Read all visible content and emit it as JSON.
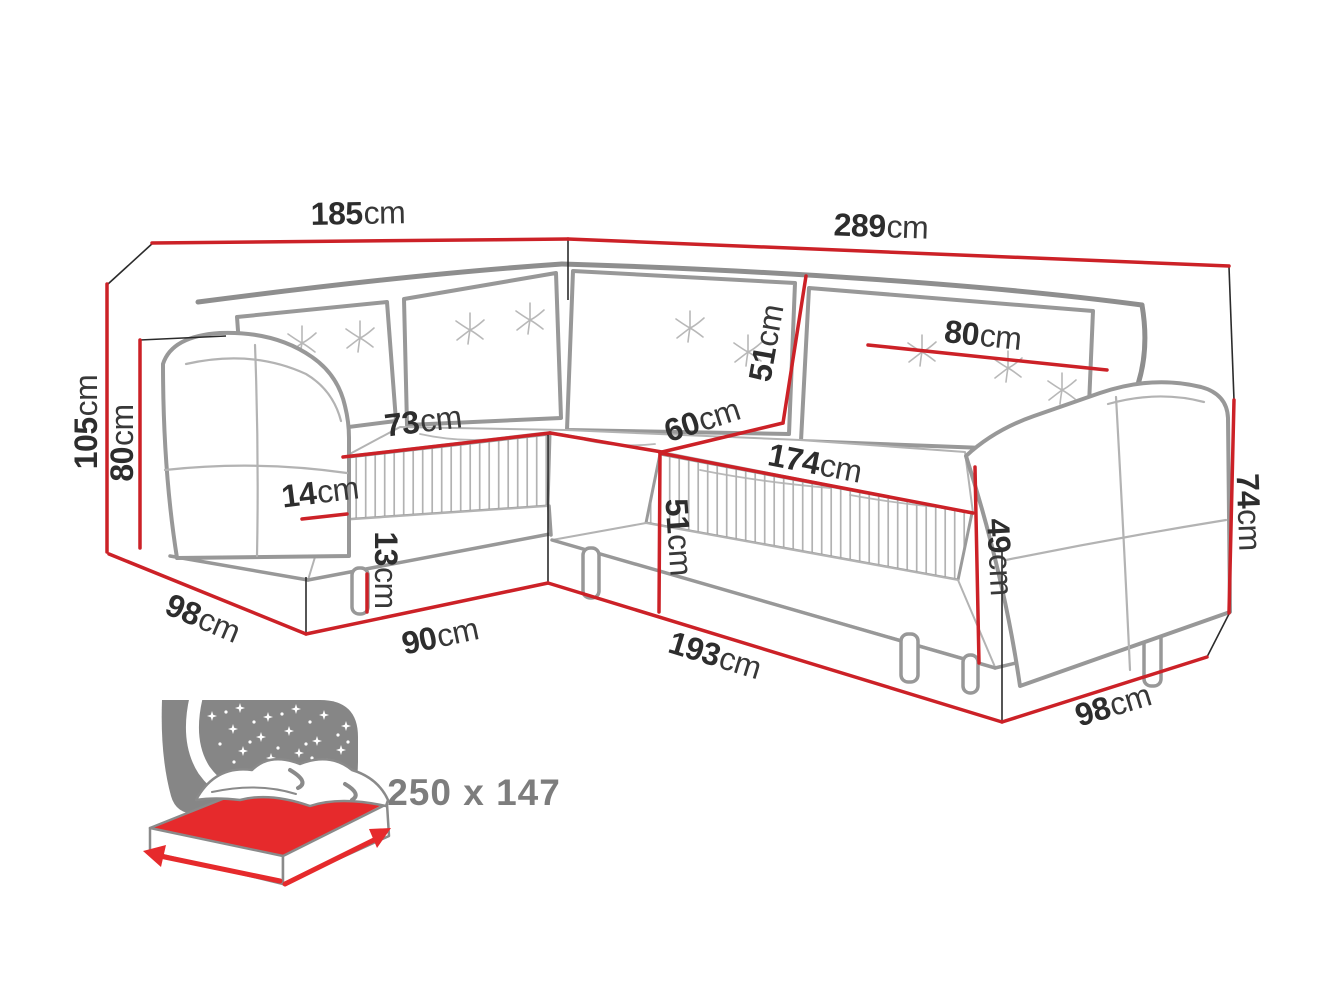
{
  "diagram": {
    "dimensions": {
      "back_width_left": {
        "value": "185",
        "unit": "cm"
      },
      "back_width_right": {
        "value": "289",
        "unit": "cm"
      },
      "height_total": {
        "value": "105",
        "unit": "cm"
      },
      "arm_height_left": {
        "value": "80",
        "unit": "cm"
      },
      "seat_depth_left": {
        "value": "73",
        "unit": "cm"
      },
      "band_height": {
        "value": "14",
        "unit": "cm"
      },
      "leg_height": {
        "value": "13",
        "unit": "cm"
      },
      "depth_left": {
        "value": "98",
        "unit": "cm"
      },
      "front_width_left": {
        "value": "90",
        "unit": "cm"
      },
      "backrest_height": {
        "value": "51",
        "unit": "cm"
      },
      "corner_width": {
        "value": "60",
        "unit": "cm"
      },
      "seat_width_right": {
        "value": "174",
        "unit": "cm"
      },
      "seat_front_height": {
        "value": "51",
        "unit": "cm"
      },
      "front_width_right": {
        "value": "193",
        "unit": "cm"
      },
      "cushion_width": {
        "value": "80",
        "unit": "cm"
      },
      "seat_height_right": {
        "value": "49",
        "unit": "cm"
      },
      "arm_height_right": {
        "value": "74",
        "unit": "cm"
      },
      "depth_right": {
        "value": "98",
        "unit": "cm"
      }
    },
    "sleeping_area": {
      "label": "250 x 147"
    },
    "colors": {
      "dimension_red": "#cc2127",
      "sofa_outline_gray": "#989898",
      "label_text": "#2d2d2d",
      "sleeping_text_gray": "#7d7d7d",
      "bed_mattress_red": "#e62a2c",
      "bed_panel_gray": "#868686"
    },
    "icons": {
      "sleeping_function": "bed-starry-night-icon"
    }
  }
}
